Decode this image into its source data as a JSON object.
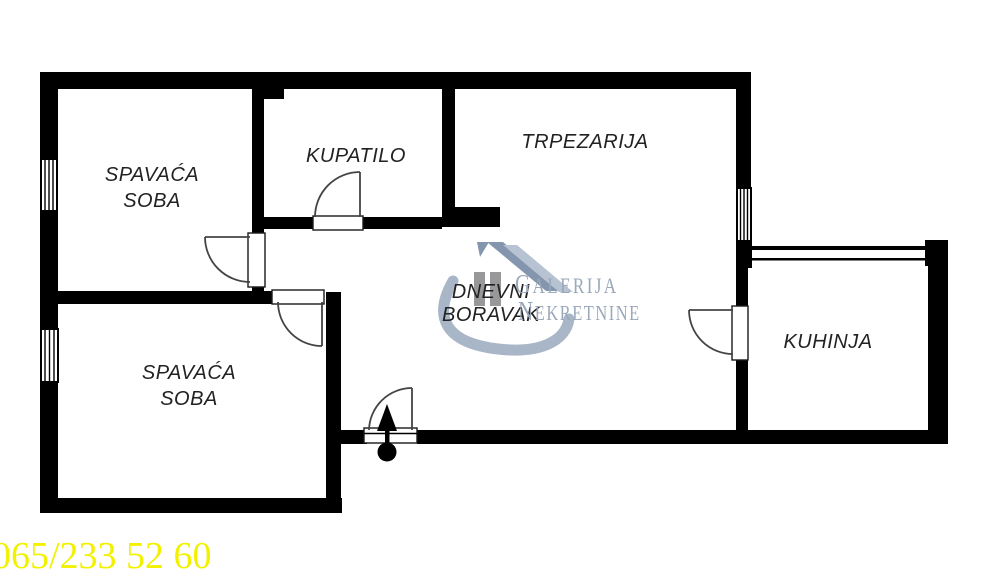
{
  "page": {
    "background": "#ffffff",
    "type": "apartment floor plan"
  },
  "colors": {
    "wall": "#000000",
    "label": "#222222",
    "door_line": "#444444",
    "phone": "#f2f200",
    "wm_text": "#9aa8ba",
    "wm_swoosh": "#a9b6c7",
    "wm_roof_dark": "#8496ad",
    "wm_roof_light": "#b7c3d2",
    "wm_pillar": "#98989a"
  },
  "rooms": [
    {
      "id": "bedroom-1",
      "label": "SPAVAĆA\nSOBA"
    },
    {
      "id": "bathroom",
      "label": "KUPATILO"
    },
    {
      "id": "dining-room",
      "label": "TRPEZARIJA"
    },
    {
      "id": "living-room",
      "label": "DNEVNI\nBORAVAK"
    },
    {
      "id": "kitchen",
      "label": "KUHINJA"
    },
    {
      "id": "bedroom-2",
      "label": "SPAVAĆA\nSOBA"
    }
  ],
  "watermark": {
    "line1": "GALERIJA",
    "line2": "NEKRETNINE"
  },
  "contact": {
    "phone": "065/233 52 60"
  }
}
